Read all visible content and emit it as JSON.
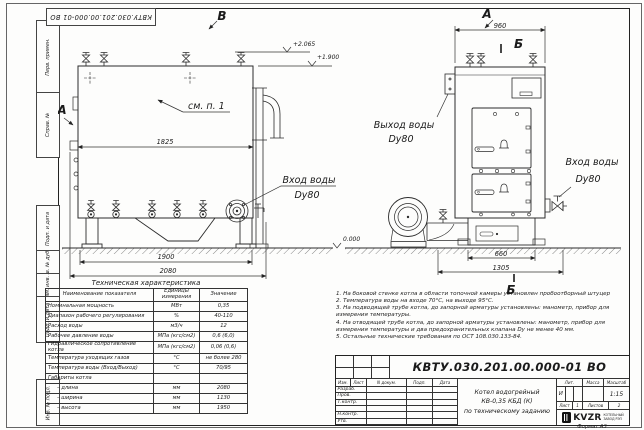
{
  "frame": {
    "stamp_top": "КВТУ.030.201.00.000-01 ВО",
    "margin_labels": [
      "Перв. примен.",
      "Справ. №",
      "Подп. и дата",
      "Инв. № дубл.",
      "Взам. инв. №",
      "Подп. и дата",
      "Инв. № подл."
    ],
    "format_label": "Формат А3"
  },
  "drawing": {
    "letters": {
      "b_top": "В",
      "a_side": "А",
      "a_front": "А",
      "b_section_top": "Б",
      "b_section_bottom": "Б"
    },
    "see_note": "см. п. 1",
    "elev_top": "+2.065",
    "elev_mid": "+1.900",
    "elev_zero": "0.000",
    "dim_side_width": "1825",
    "dim_side_base": "1900",
    "dim_side_total": "2080",
    "dim_front_top": "960",
    "dim_front_base": "660",
    "dim_front_total": "1305",
    "inlet_side_line1": "Вход воды",
    "inlet_side_line2": "Dy80",
    "outlet_front_line1": "Выход воды",
    "outlet_front_line2": "Dy80",
    "inlet_front_line1": "Вход воды",
    "inlet_front_line2": "Dy80"
  },
  "spec_table": {
    "title": "Техническая характеристика",
    "col_headers": [
      "Наименование показателя",
      "Единицы измерения",
      "Значение"
    ],
    "rows": [
      [
        "Номинальная мощность",
        "МВт",
        "0,35"
      ],
      [
        "Диапазон рабочего регулирования",
        "%",
        "40-110"
      ],
      [
        "Расход воды",
        "м3/ч",
        "12"
      ],
      [
        "Рабочее давление воды",
        "МПа (кгс/см2)",
        "0,6 (6,0)"
      ],
      [
        "Гидравлическое сопротивление котла",
        "МПа (кгс/см2)",
        "0,06 (0,6)"
      ],
      [
        "Температура уходящих газов",
        "°С",
        "не более 280"
      ],
      [
        "Температура воды (Вход/Выход)",
        "°С",
        "70/95"
      ],
      [
        "Габариты котла",
        "",
        ""
      ],
      [
        "– длина",
        "мм",
        "2080"
      ],
      [
        "– ширина",
        "мм",
        "1130"
      ],
      [
        "– высота",
        "мм",
        "1950"
      ]
    ]
  },
  "notes": [
    "1. На боковой стенке котла в области топочной камеры установлен пробоотборный штуцер",
    "2. Температура воды на входе 70°С, на выходе 95°С.",
    "3. На подводящей трубе котла, до запорной арматуры установлены: манометр, прибор для измерения температуры.",
    "4. На отводящей трубе котла, до запорной арматуры установлены: манометр, прибор для измерения температуры и два предохранительных клапана Dу не менее 40 мм.",
    "5. Остальные технические требования по ОСТ 108.030.133-84."
  ],
  "title_block": {
    "doc_number": "КВТУ.030.201.00.000-01 ВО",
    "columns": [
      "Изм.",
      "Лист",
      "N докум.",
      "Подп.",
      "Дата"
    ],
    "roles": [
      "Разраб.",
      "Пров.",
      "Т.контр.",
      "",
      "Н.контр.",
      "Утв."
    ],
    "product_name_1": "Котел водогрейный",
    "product_name_2": "КВ-0,35 КБД (К)",
    "product_name_3": "по техническому заданию",
    "lit_label": "Лит.",
    "mass_label": "Масса",
    "scale_label": "Масштаб",
    "lit_value": "И",
    "scale_value": "1:15",
    "sheet_label": "Лист",
    "sheet_value": "1",
    "sheets_label": "Листов",
    "sheets_value": "2",
    "logo_text": "KVZR",
    "logo_caption_1": "КОТЕЛЬНЫЙ",
    "logo_caption_2": "ЗАВОД РЭП"
  }
}
